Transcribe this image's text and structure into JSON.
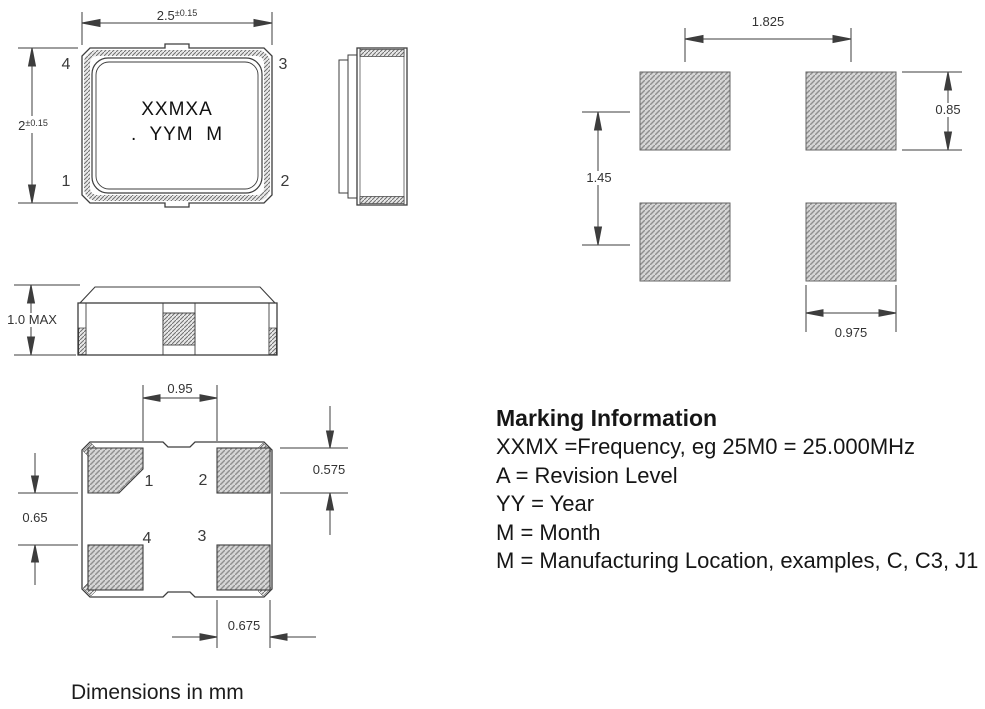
{
  "colors": {
    "line": "#3d3d3d",
    "hatch_fill": "#d6d6d6",
    "hatch_stroke": "#8f8f8f"
  },
  "views": {
    "top": {
      "dim_width_value": "2.5",
      "dim_width_tol": "±0.15",
      "dim_height_value": "2",
      "dim_height_tol": "±0.15",
      "pin_tl": "4",
      "pin_tr": "3",
      "pin_bl": "1",
      "pin_br": "2",
      "marking_line1": "XXMXA",
      "marking_line2": ".  YYM  M"
    },
    "front": {
      "dim_height": "1.0 MAX"
    },
    "bottom": {
      "dim_center_gap": "0.95",
      "dim_pad_height": "0.575",
      "dim_row_gap": "0.65",
      "dim_pad_width": "0.675",
      "pin_tl": "1",
      "pin_tr": "2",
      "pin_bl": "4",
      "pin_br": "3"
    },
    "land_pattern": {
      "dim_pitch_x": "1.825",
      "dim_pad_height": "0.85",
      "dim_pitch_y": "1.45",
      "dim_pad_width": "0.975"
    }
  },
  "marking_info": {
    "title": "Marking Information",
    "lines": [
      "XXMX =Frequency, eg 25M0 = 25.000MHz",
      "A = Revision Level",
      "YY = Year",
      "M = Month",
      "M = Manufacturing Location, examples, C, C3, J1"
    ]
  },
  "footer_note": "Dimensions in mm"
}
